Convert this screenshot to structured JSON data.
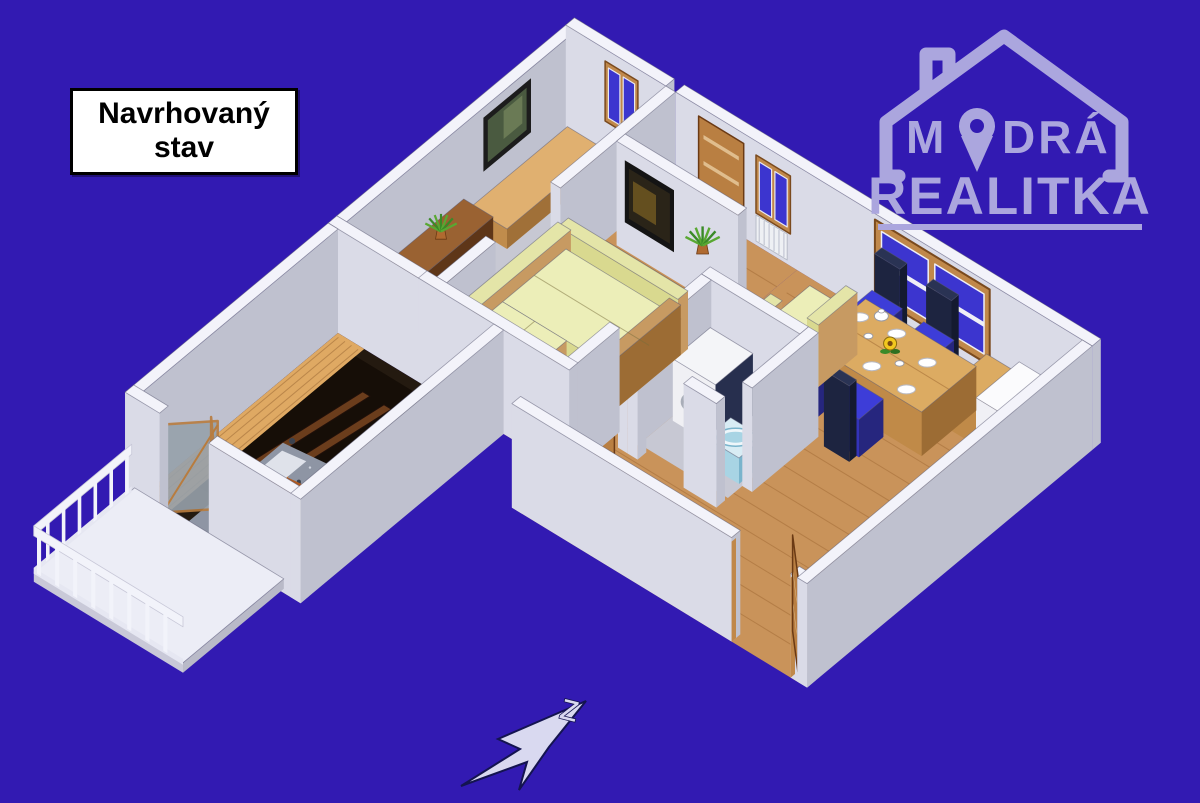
{
  "page": {
    "background": "#321ab2"
  },
  "state_label": {
    "line1": "Navrhovaný",
    "line2": "stav"
  },
  "logo": {
    "word_top_pre": "M",
    "word_top_post": "DRÁ",
    "word_bottom": "REALITKA",
    "color": "#aba6de"
  },
  "compass": {
    "letter": "Z"
  },
  "palette": {
    "bg": "#321ab2",
    "wallTop": "#f3f3fa",
    "wallFace": "#dadbe7",
    "wallSide": "#bfc1cf",
    "floorWood": "#c9935a",
    "woodLine": "rgba(140,85,35,0.35)",
    "floorGray": "#c7c8d3",
    "glassBlue": "#3c35cf",
    "frameWood": "#c0884a",
    "frameWoodDark": "#7a4a1e",
    "doorWood": "#b97f42",
    "cushion": "#eceeb8",
    "cushionSide": "#d9d98f",
    "sofaFrame": "#c79a62",
    "navy": "#1d2440",
    "chairBlue": "#3d3dd8",
    "washerNavy": "#272f4e",
    "sinkBlue": "#a8d4e4",
    "darkRoom": "#241a10",
    "darkMass": "#160e07",
    "plank": "#dfa963",
    "speckle": "#8e95a4",
    "speckleDot": "#3c424e",
    "orange": "#b05a20",
    "white": "#f6f6f8",
    "tvFrame": "#141414",
    "tvScreen": "#2a2418",
    "plantGreen": "#3a8a28",
    "sunflower": "#f2c81e",
    "compassFill": "#d9d9f0",
    "compassStroke": "#141450"
  }
}
